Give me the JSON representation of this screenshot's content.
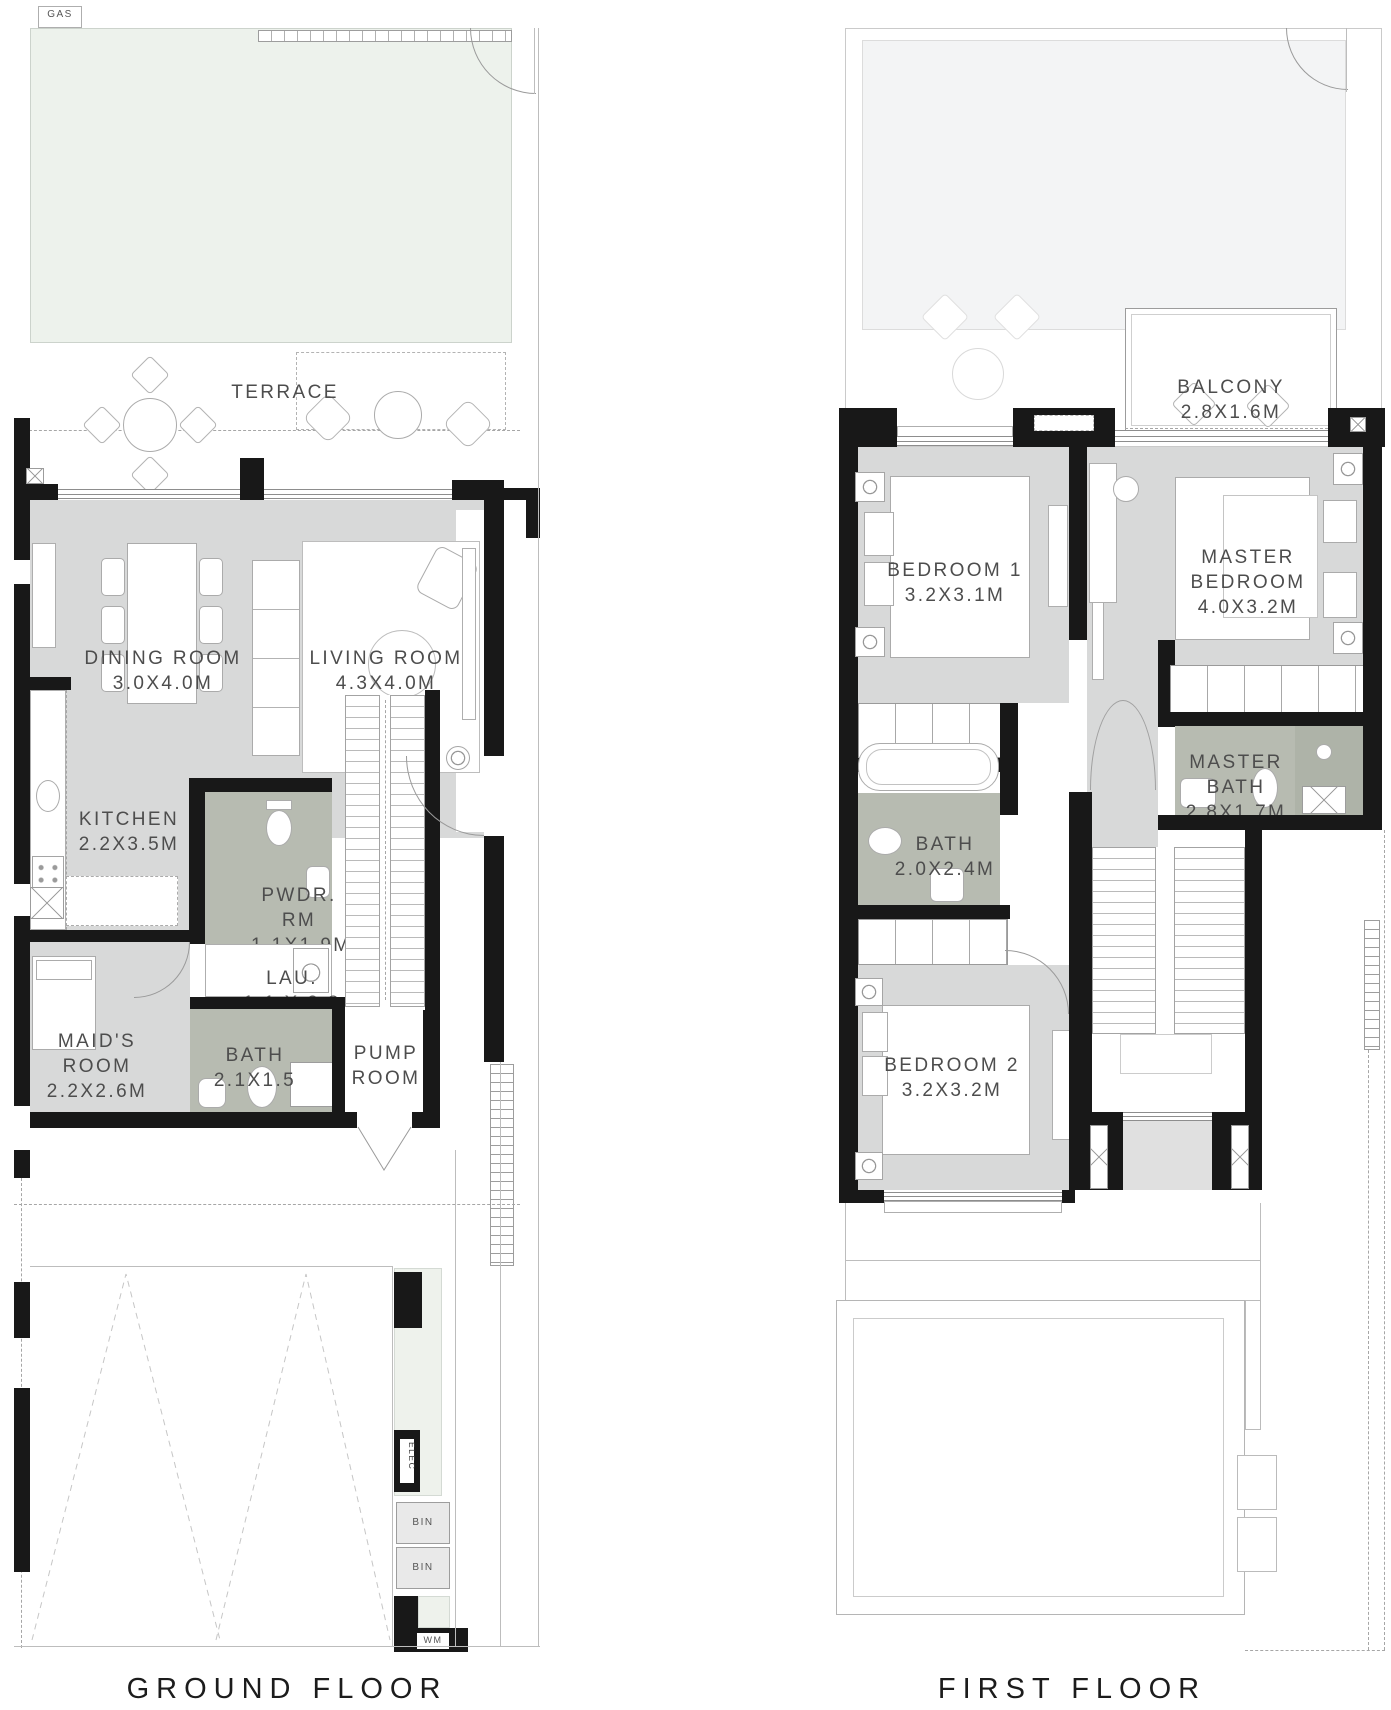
{
  "colors": {
    "wall": "#181818",
    "interior_floor": "#d8d9d9",
    "wet_floor": "#b7bbb1",
    "lawn": "#edf2ec",
    "roof_pale": "#f3f4f5"
  },
  "ground_floor": {
    "title": "GROUND FLOOR",
    "gas_label": "GAS",
    "rooms": {
      "terrace": {
        "name": "TERRACE"
      },
      "dining": {
        "name": "DINING ROOM",
        "dims": "3.0X4.0M"
      },
      "living": {
        "name": "LIVING ROOM",
        "dims": "4.3X4.0M"
      },
      "kitchen": {
        "name": "KITCHEN",
        "dims": "2.2X3.5M"
      },
      "powder": {
        "name": "PWDR. RM",
        "dims": "1.1X1.9M"
      },
      "laundry": {
        "name": "LAU.",
        "dims": "1.1 X 0.8"
      },
      "maids": {
        "name": "MAID'S ROOM",
        "dims": "2.2X2.6M"
      },
      "bath": {
        "name": "BATH",
        "dims": "2.1X1.5"
      },
      "pump": {
        "name": "PUMP ROOM"
      }
    },
    "utility": {
      "elec": "ELEC",
      "bin1": "BIN",
      "bin2": "BIN",
      "wm": "WM"
    }
  },
  "first_floor": {
    "title": "FIRST FLOOR",
    "rooms": {
      "balcony": {
        "name": "BALCONY",
        "dims": "2.8X1.6M"
      },
      "bedroom1": {
        "name": "BEDROOM 1",
        "dims": "3.2X3.1M"
      },
      "master_bedroom": {
        "name": "MASTER BEDROOM",
        "dims": "4.0X3.2M"
      },
      "bath": {
        "name": "BATH",
        "dims": "2.0X2.4M"
      },
      "master_bath": {
        "name": "MASTER BATH",
        "dims": "2.8X1.7M"
      },
      "bedroom2": {
        "name": "BEDROOM 2",
        "dims": "3.2X3.2M"
      }
    }
  }
}
